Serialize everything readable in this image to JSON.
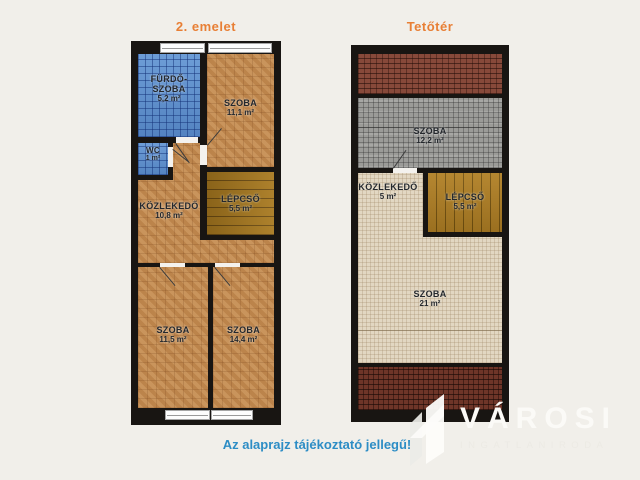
{
  "colors": {
    "background": "#f1efea",
    "wall": "#181512",
    "title_orange": "#e87f35",
    "disclaimer_blue": "#2d8dc5",
    "blue_tile": "#5d92d2",
    "parquet": "#c28a50",
    "gray_tile": "#9b9b98",
    "carpet": "#e2d7c2",
    "stairs": "#a8791f",
    "roof_brick": "#87493a"
  },
  "left_plan": {
    "title": "2. emelet",
    "rooms": {
      "furdoszoba": {
        "name": "FÜRDŐ-\nSZOBA",
        "area": "5,2 m²"
      },
      "szoba_felso": {
        "name": "SZOBA",
        "area": "11,1 m²"
      },
      "wc": {
        "name": "WC",
        "area": "1 m²"
      },
      "kozlekedo": {
        "name": "KÖZLEKEDŐ",
        "area": "10,8 m²"
      },
      "lepcso": {
        "name": "LÉPCSŐ",
        "area": "5,5 m²"
      },
      "szoba_also_bal": {
        "name": "SZOBA",
        "area": "11,5 m²"
      },
      "szoba_also_jobb": {
        "name": "SZOBA",
        "area": "14,4 m²"
      }
    }
  },
  "right_plan": {
    "title": "Tetőtér",
    "rooms": {
      "szoba_felso": {
        "name": "SZOBA",
        "area": "12,2 m²"
      },
      "kozlekedo": {
        "name": "KÖZLEKEDŐ",
        "area": "5 m²"
      },
      "lepcso": {
        "name": "LÉPCSŐ",
        "area": "5,5 m²"
      },
      "szoba_also": {
        "name": "SZOBA",
        "area": "21 m²"
      }
    }
  },
  "disclaimer": "Az alaprajz tájékoztató jellegű!",
  "logo": {
    "name": "VÁROSI",
    "subtitle": "INGATLANIRODA"
  }
}
